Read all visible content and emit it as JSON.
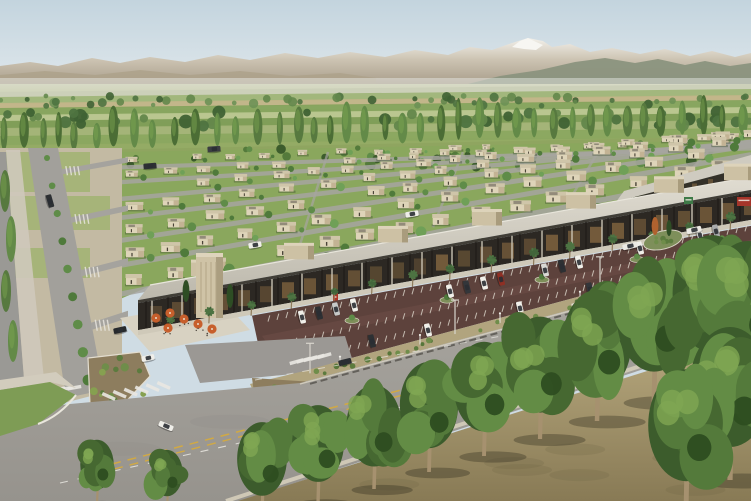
{
  "scene": {
    "type": "aerial-architectural-rendering",
    "title": "Aerial rendering of a master-planned desert community: rows of flat-roof homes behind a retail strip with palm-lined storefronts, red-brown parking lot, landscaped boulevard and foreground tree row, snow-capped mountains on the horizon",
    "colors": {
      "sky_top": "#c3d4de",
      "sky_horizon": "#e9eef0",
      "snow": "#f2f0ea",
      "mountain_light": "#cdc4b3",
      "mountain_dark": "#a79c89",
      "ridge": "#8b947e",
      "ridge_left": "#aca189",
      "valley_light": "#d8dac6",
      "valley_green": "#93ab64",
      "tree_dark": "#3c5c2c",
      "tree_mid": "#547a3b",
      "tree_light": "#7fa652",
      "lawn": "#8aa75d",
      "street": "#a7a5a0",
      "dirt_lot": "#c3baa3",
      "house_wall": "#ded4b9",
      "house_shade": "#c3b394",
      "house_roof": "#cfc5a9",
      "roof_patch": "#8b8474",
      "canopy": "#cfcbc0",
      "fascia": "#413e37",
      "storefront": "#2c2823",
      "glow": "#b98c52",
      "walkway": "#cfc9b9",
      "tower": "#cfc3a6",
      "palm": "#41653a",
      "umbrella": "#c75f2c",
      "parking": "#5d423c",
      "parking_aisle": "#6b4b44",
      "stripe": "#ded9cd",
      "median_mulch": "#8d7d5e",
      "shrub": "#5c7b3e",
      "boulevard": "#a3a09a",
      "yellow_line": "#d1a944",
      "white_line": "#e9e7e1",
      "curb": "#d6d0c1",
      "fg_ground": "#b7a87e",
      "fg_ground_dark": "#887a55",
      "trunk": "#a6916f"
    }
  },
  "field_strips": [
    {
      "y": 88,
      "h": 6,
      "c": "#cbd0b8"
    },
    {
      "y": 93,
      "h": 7,
      "c": "#9fb579"
    },
    {
      "y": 99,
      "h": 6,
      "c": "#c2b488"
    },
    {
      "y": 104,
      "h": 8,
      "c": "#85a35c"
    },
    {
      "y": 111,
      "h": 7,
      "c": "#b9c68f"
    },
    {
      "y": 117,
      "h": 8,
      "c": "#7d9c55"
    },
    {
      "y": 124,
      "h": 9,
      "c": "#a3b377"
    },
    {
      "y": 132,
      "h": 10,
      "c": "#8aa75f"
    },
    {
      "y": 141,
      "h": 12,
      "c": "#93ab64"
    }
  ],
  "house_rows": [
    {
      "y0": 158,
      "m": 0.03,
      "s": 0.55
    },
    {
      "y0": 172,
      "m": 0.06,
      "s": 0.65
    },
    {
      "y0": 188,
      "m": 0.09,
      "s": 0.75
    },
    {
      "y0": 206,
      "m": 0.12,
      "s": 0.85
    },
    {
      "y0": 228,
      "m": 0.15,
      "s": 0.95
    },
    {
      "y0": 252,
      "m": 0.175,
      "s": 1.05
    },
    {
      "y0": 280,
      "m": 0.195,
      "s": 1.15
    }
  ],
  "cross_street_x": [
    320,
    455,
    590,
    700
  ],
  "left_edge_poplars": [
    {
      "x": 5,
      "y": 212,
      "h": 42
    },
    {
      "x": 11,
      "y": 262,
      "h": 46
    },
    {
      "x": 6,
      "y": 312,
      "h": 42
    },
    {
      "x": 13,
      "y": 362,
      "h": 42
    }
  ],
  "strip": {
    "rooftop_box_x": [
      205,
      298,
      392,
      486,
      580,
      668,
      738
    ],
    "tower": {
      "x": 196,
      "y": 256,
      "w": 27,
      "h": 62
    },
    "palm": {
      "x0": 170,
      "x1": 744,
      "step": 36
    },
    "umbrellas": [
      {
        "x": 156,
        "y": 318
      },
      {
        "x": 170,
        "y": 313
      },
      {
        "x": 184,
        "y": 319
      },
      {
        "x": 198,
        "y": 324
      },
      {
        "x": 212,
        "y": 329
      },
      {
        "x": 168,
        "y": 328
      }
    ],
    "signs": [
      {
        "x": 737,
        "y": 197,
        "w": 14,
        "h": 9,
        "c": "#a5352a"
      },
      {
        "x": 684,
        "y": 197,
        "w": 9,
        "h": 7,
        "c": "#3e7a47"
      },
      {
        "x": 333,
        "y": 293,
        "w": 5,
        "h": 11,
        "c": "#b03426"
      }
    ]
  },
  "parking": {
    "island_x": [
      352,
      447,
      542,
      637,
      722
    ],
    "cars": [
      {
        "x": 302,
        "y": 317,
        "c": "#f0efe9"
      },
      {
        "x": 319,
        "y": 313,
        "c": "#2d3033"
      },
      {
        "x": 336,
        "y": 309,
        "c": "#c7c9c8"
      },
      {
        "x": 354,
        "y": 305,
        "c": "#f0efe9"
      },
      {
        "x": 450,
        "y": 291,
        "c": "#f0efe9"
      },
      {
        "x": 467,
        "y": 287,
        "c": "#33363a"
      },
      {
        "x": 484,
        "y": 283,
        "c": "#f0efe9"
      },
      {
        "x": 501,
        "y": 279,
        "c": "#8e2f24"
      },
      {
        "x": 545,
        "y": 270,
        "c": "#d9d9d4"
      },
      {
        "x": 562,
        "y": 266,
        "c": "#2d3033"
      },
      {
        "x": 579,
        "y": 262,
        "c": "#f0efe9"
      },
      {
        "x": 640,
        "y": 248,
        "c": "#f0efe9"
      },
      {
        "x": 657,
        "y": 244,
        "c": "#2d3033"
      },
      {
        "x": 700,
        "y": 235,
        "c": "#f0efe9"
      },
      {
        "x": 716,
        "y": 231,
        "c": "#a9abac"
      },
      {
        "x": 372,
        "y": 341,
        "c": "#2d3033"
      },
      {
        "x": 428,
        "y": 330,
        "c": "#f0efe9"
      },
      {
        "x": 520,
        "y": 308,
        "c": "#f0efe9"
      },
      {
        "x": 590,
        "y": 289,
        "c": "#33363a"
      },
      {
        "x": 646,
        "y": 276,
        "c": "#c7c9c8"
      },
      {
        "x": 698,
        "y": 255,
        "c": "#f0efe9"
      },
      {
        "x": 630,
        "y": 246,
        "c": "#eceae4",
        "r": -13,
        "l": 15
      },
      {
        "x": 694,
        "y": 230,
        "c": "#eceae4",
        "r": -13,
        "l": 15
      }
    ]
  },
  "median": {
    "lamp_x": [
      340,
      420,
      500,
      580,
      660,
      735
    ],
    "tall_pole_x": [
      310,
      455,
      600
    ]
  },
  "crosswalks": [
    {
      "x": 34,
      "y": 390,
      "n": 6,
      "dx": 8,
      "dy": -0.8,
      "rot": 80
    },
    {
      "x": 108,
      "y": 398,
      "n": 6,
      "dx": 11,
      "dy": -2.2,
      "rot": -66
    },
    {
      "x": 296,
      "y": 360,
      "n": 5,
      "dx": 7,
      "dy": -1.5,
      "rot": 74
    },
    {
      "x": 578,
      "y": 302,
      "n": 4,
      "dx": 6.5,
      "dy": -1.4,
      "rot": 74
    }
  ],
  "road_cars": [
    {
      "x": 166,
      "y": 426,
      "c": "#efeee9",
      "r": 23,
      "l": 15
    },
    {
      "x": 345,
      "y": 362,
      "c": "#2b2e32",
      "r": -14
    },
    {
      "x": 628,
      "y": 343,
      "c": "#2b2e32",
      "r": -12
    },
    {
      "x": 672,
      "y": 273,
      "c": "#eceae4",
      "r": -12
    },
    {
      "x": 712,
      "y": 263,
      "c": "#3a3d41",
      "r": -12
    },
    {
      "x": 148,
      "y": 358,
      "c": "#efeee9",
      "r": -12
    }
  ],
  "grid_cars": [
    {
      "x": 150,
      "y": 166,
      "c": "#2d3033",
      "r": -5
    },
    {
      "x": 214,
      "y": 149,
      "c": "#3a3d41",
      "r": -4
    },
    {
      "x": 255,
      "y": 245,
      "c": "#efeee9",
      "r": -10
    },
    {
      "x": 412,
      "y": 214,
      "c": "#efeee9",
      "r": -10
    },
    {
      "x": 96,
      "y": 396,
      "c": "#efeee9",
      "r": 74
    },
    {
      "x": 50,
      "y": 201,
      "c": "#2d3033",
      "r": 74
    },
    {
      "x": 120,
      "y": 330,
      "c": "#26292c",
      "r": -12
    }
  ],
  "roundabout": {
    "cx": 663,
    "cy": 240,
    "accent_tree": "#b0622f"
  },
  "foreground_trees": [
    {
      "x": 97,
      "y": 503,
      "h": 62
    },
    {
      "x": 167,
      "y": 509,
      "h": 58
    },
    {
      "x": 262,
      "y": 516,
      "h": 92
    },
    {
      "x": 318,
      "y": 503,
      "h": 96
    },
    {
      "x": 374,
      "y": 489,
      "h": 102
    },
    {
      "x": 429,
      "y": 472,
      "h": 108
    },
    {
      "x": 484,
      "y": 456,
      "h": 112
    },
    {
      "x": 540,
      "y": 439,
      "h": 120
    },
    {
      "x": 597,
      "y": 421,
      "h": 128
    },
    {
      "x": 654,
      "y": 402,
      "h": 138
    },
    {
      "x": 712,
      "y": 384,
      "h": 146
    },
    {
      "x": 748,
      "y": 394,
      "h": 150
    },
    {
      "x": 730,
      "y": 480,
      "h": 150
    },
    {
      "x": 686,
      "y": 512,
      "h": 140
    }
  ]
}
